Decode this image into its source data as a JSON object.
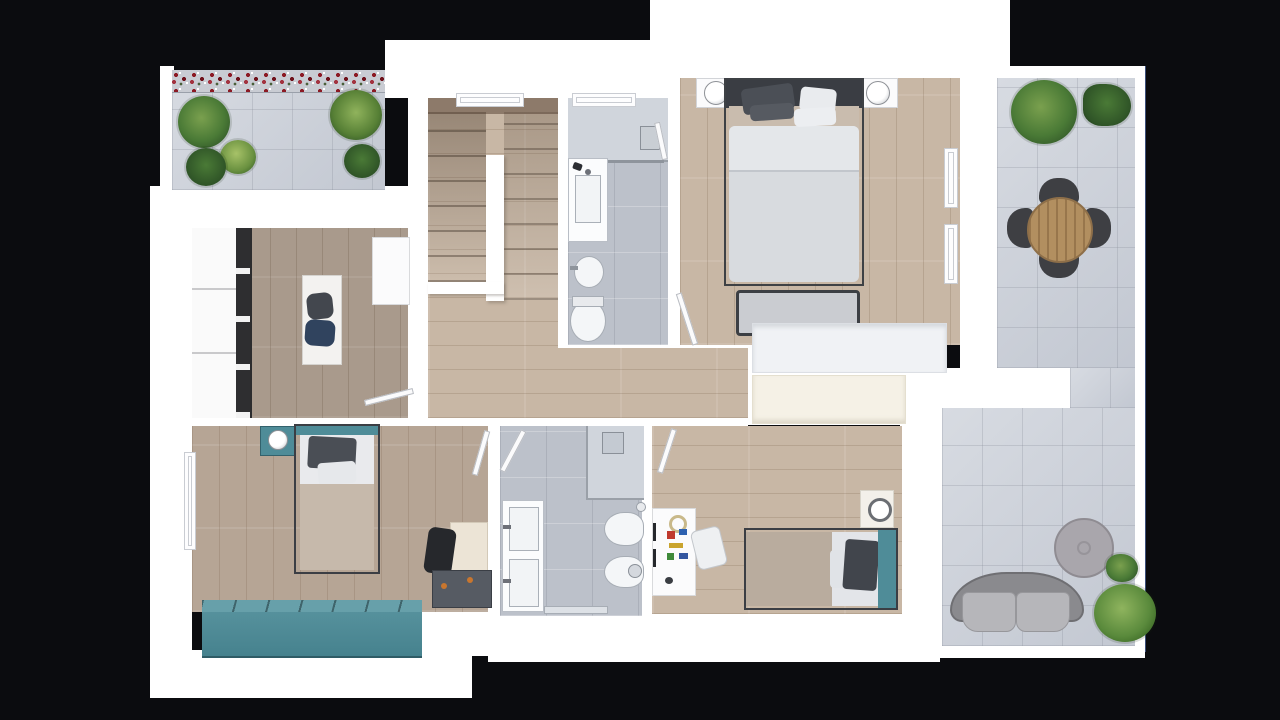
{
  "scene": {
    "type": "3d-floor-plan-top-view",
    "floor": "upper-floor-apartment",
    "background": "black"
  },
  "colors": {
    "background": "#0b0c0f",
    "wall": "#ffffff",
    "wall_shade": "#eef0f3",
    "wood_light": "#c8b7a5",
    "wood_office": "#a99a8c",
    "wood_dark": "#8d7a6a",
    "tile_bath": "#bcc1ca",
    "tile_shower": "#d0d5dc",
    "tile_terrace": "#cacfd8",
    "teal": "#4f8c98",
    "navy": "#30435e",
    "dark_furniture": "#43474e",
    "charcoal": "#26282c",
    "duvet": "#d8dbdf",
    "beige": "#c6b9ab",
    "cream": "#f5f1e6",
    "white_furniture": "#f7f8f9",
    "outdoor_gray": "#8a8a8e",
    "cushion_gray": "#b6b6ba",
    "table_wood": "#b28f60",
    "plant_dark": "#2f5427",
    "plant_mid": "#4a7a36",
    "plant_light": "#7aa04e",
    "flower_red": "#8c1a24",
    "orange_handle": "#c8762e"
  },
  "rooms": [
    {
      "name": "terrace-top-left",
      "floor": "concrete-tiles",
      "furniture": [
        "flower-planter",
        "plants"
      ]
    },
    {
      "name": "office-dressing-room",
      "floor": "wood",
      "furniture": [
        "wardrobe-shelving",
        "desk",
        "chair-dark",
        "chair-navy",
        "cabinet",
        "door"
      ]
    },
    {
      "name": "staircase",
      "floor": "wood",
      "furniture": [
        "u-shaped-stairs",
        "window"
      ]
    },
    {
      "name": "bathroom-top",
      "floor": "gray-tile",
      "furniture": [
        "shower",
        "vanity-sink",
        "bidet",
        "toilet",
        "window",
        "door"
      ]
    },
    {
      "name": "master-bedroom",
      "floor": "wood",
      "furniture": [
        "double-bed",
        "nightstand-left",
        "nightstand-right",
        "lamps",
        "bench",
        "wardrobe",
        "windows",
        "door"
      ]
    },
    {
      "name": "hallway",
      "floor": "wood",
      "furniture": []
    },
    {
      "name": "bedroom-bottom-left",
      "floor": "wood",
      "furniture": [
        "single-bed",
        "teal-nightstand",
        "lamp",
        "desk",
        "black-chair",
        "drawer-cabinet",
        "teal-storage-bench",
        "window"
      ]
    },
    {
      "name": "bathroom-bottom",
      "floor": "gray-tile",
      "furniture": [
        "shower",
        "double-vanity",
        "toilet",
        "bidet",
        "door"
      ]
    },
    {
      "name": "kids-bedroom",
      "floor": "wood",
      "furniture": [
        "single-bed-teal-headboard",
        "desk-with-toys",
        "white-chair",
        "nightstand",
        "wardrobe-cream",
        "door"
      ]
    },
    {
      "name": "terrace-right",
      "floor": "concrete-tiles",
      "furniture": [
        "round-dining-table",
        "four-outdoor-chairs",
        "plants",
        "outdoor-sofa",
        "round-coffee-table"
      ]
    }
  ]
}
